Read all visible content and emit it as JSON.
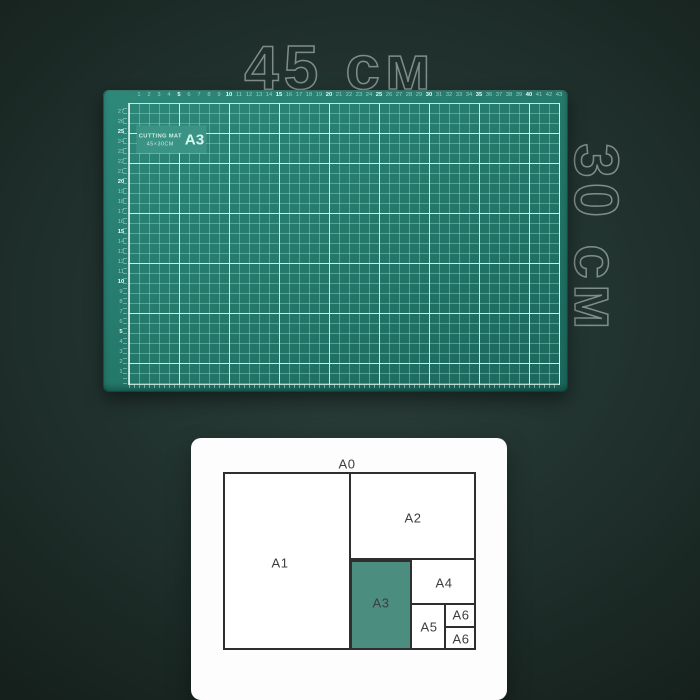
{
  "scene": {
    "dimension_width_label": "45 см",
    "dimension_height_label": "30 см"
  },
  "mat": {
    "badge_line1": "CUTTING MAT",
    "badge_line2": "45×30CM",
    "badge_size": "A3",
    "top_ruler": [
      1,
      2,
      3,
      4,
      5,
      6,
      7,
      8,
      9,
      10,
      11,
      12,
      13,
      14,
      15,
      16,
      17,
      18,
      19,
      20,
      21,
      22,
      23,
      24,
      25,
      26,
      27,
      28,
      29,
      30,
      31,
      32,
      33,
      34,
      35,
      36,
      37,
      38,
      39,
      40,
      41,
      42,
      43
    ],
    "left_ruler": [
      27,
      26,
      25,
      24,
      23,
      22,
      21,
      20,
      19,
      18,
      17,
      16,
      15,
      14,
      13,
      12,
      11,
      10,
      9,
      8,
      7,
      6,
      5,
      4,
      3,
      2,
      1
    ]
  },
  "paper_chart": {
    "type": "treemap-of-paper-sizes",
    "title": "A0",
    "a1": "A1",
    "a2": "A2",
    "a3": "A3",
    "a4": "A4",
    "a5": "A5",
    "a6_top": "A6",
    "a6_bottom": "A6",
    "highlight": "#4b8e7f"
  },
  "colors": {
    "background_center": "#2c403a",
    "background_edge": "#15201c",
    "mat_surface": "#23786c",
    "grid_minor": "#96d6c9",
    "grid_major": "#e4f8f2",
    "badge_bg": "#3a9384",
    "card_bg": "#fdfdfd",
    "diagram_line": "#2e2e2e",
    "outline_text": "#ccd8d4"
  }
}
